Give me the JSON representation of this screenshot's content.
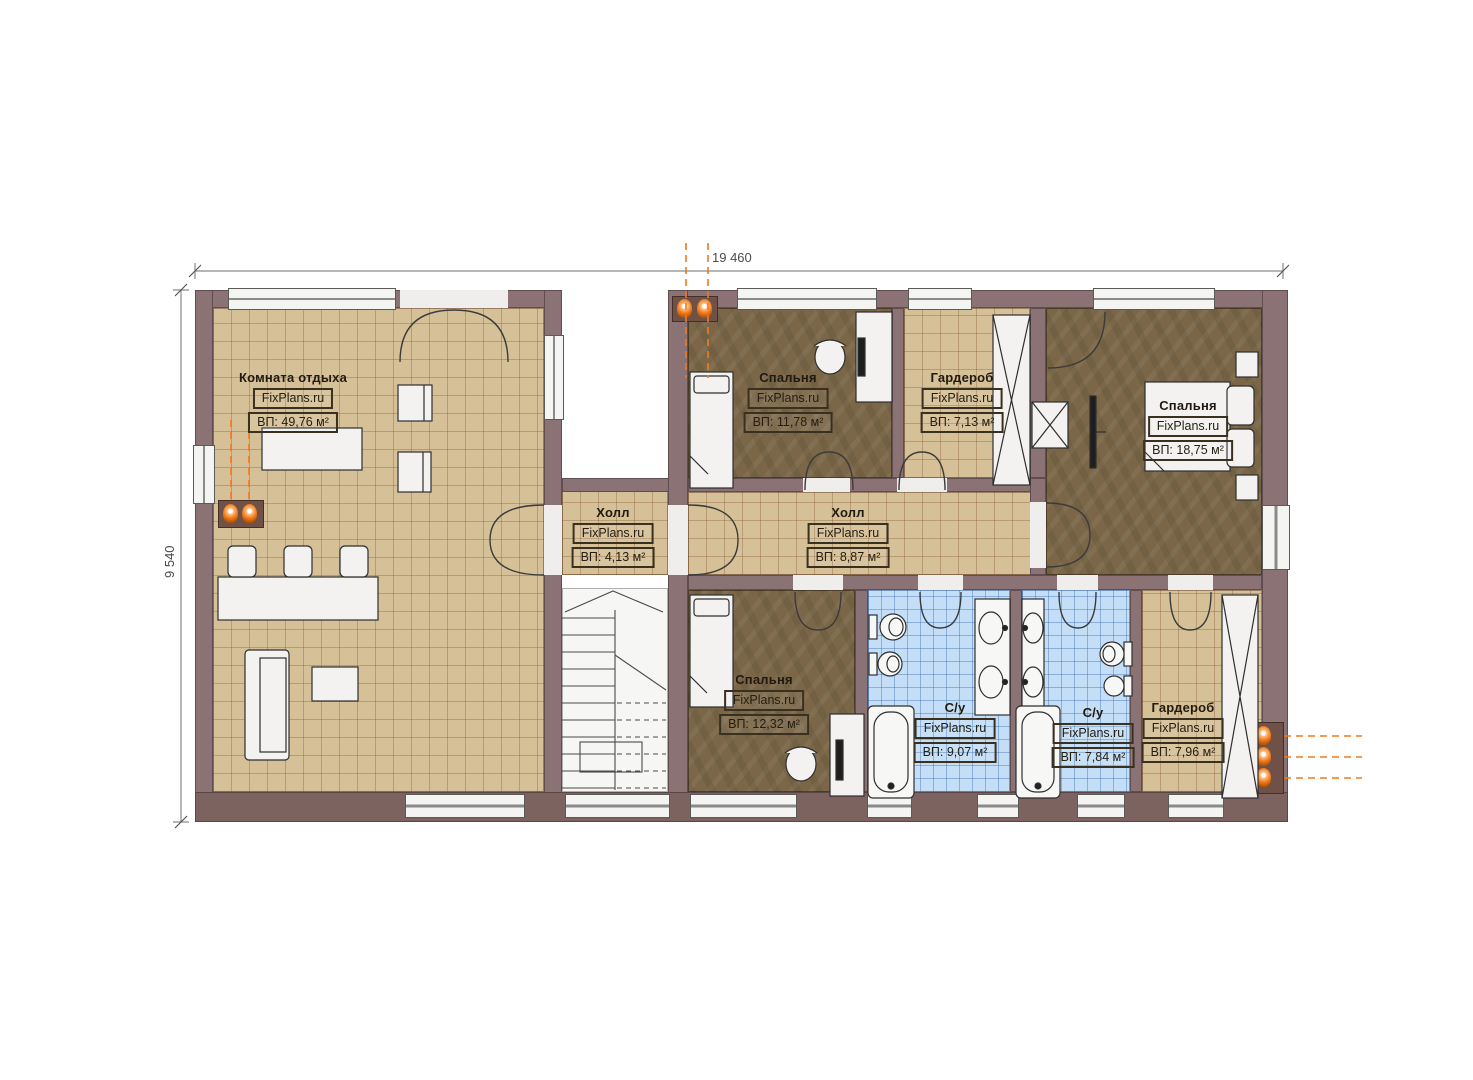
{
  "plan": {
    "brand": "FixPlans.ru",
    "dimensions": {
      "width": "19 460",
      "height": "9 540"
    },
    "rooms": [
      {
        "name": "Комната отдыха",
        "watermark": "FixPlans.ru",
        "area": "ВП: 49,76 м²"
      },
      {
        "name": "Спальня",
        "watermark": "FixPlans.ru",
        "area": "ВП: 11,78 м²"
      },
      {
        "name": "Гардероб",
        "watermark": "FixPlans.ru",
        "area": "ВП: 7,13 м²"
      },
      {
        "name": "Спальня",
        "watermark": "FixPlans.ru",
        "area": "ВП: 18,75 м²"
      },
      {
        "name": "Холл",
        "watermark": "FixPlans.ru",
        "area": "ВП: 4,13 м²"
      },
      {
        "name": "Холл",
        "watermark": "FixPlans.ru",
        "area": "ВП: 8,87 м²"
      },
      {
        "name": "Спальня",
        "watermark": "FixPlans.ru",
        "area": "ВП: 12,32 м²"
      },
      {
        "name": "С/у",
        "watermark": "FixPlans.ru",
        "area": "ВП: 9,07 м²"
      },
      {
        "name": "С/у",
        "watermark": "FixPlans.ru",
        "area": "ВП: 7,84 м²"
      },
      {
        "name": "Гардероб",
        "watermark": "FixPlans.ru",
        "area": "ВП: 7,96 м²"
      }
    ],
    "colors": {
      "accent_orange": "#f07a1c",
      "wall": "#8a7275",
      "tile_floor": "#d6c098",
      "wood_floor": "#7b6748",
      "bath_tile": "#c3def6"
    }
  }
}
